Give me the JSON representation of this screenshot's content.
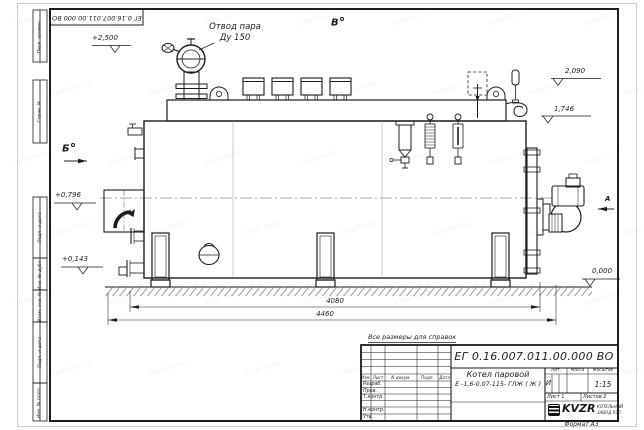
{
  "sheet": {
    "doc_number": "ЕГ 0.16.007.011.00.000  ВО",
    "format_label": "Формат А3",
    "reference_note": "Все размеры для справок",
    "watermark": "kotel-kv.kz"
  },
  "margin_graphs": {
    "perv_primen": "Перв. примен.",
    "sprav_no": "Справ. №",
    "podp_data_1": "Подп. и дата",
    "inv_dubl": "Инв. № дубл.",
    "vzam_inv": "Взам. инв. №",
    "podp_data_2": "Подп. и дата",
    "inv_podl": "Инв. № подл."
  },
  "annotations": {
    "steam_outlet_line1": "Отвод пара",
    "steam_outlet_line2": "Ду 150",
    "view_a": "А",
    "view_b": "Б",
    "view_v": "В",
    "levels": {
      "l2500": "+2,500",
      "l2090": "2,090",
      "l1746": "1,746",
      "l0796": "+0,796",
      "l0143": "+0,143",
      "l0000": "0,000"
    },
    "dims": {
      "d4080": "4080",
      "d4460": "4460"
    }
  },
  "title_block": {
    "product_name_line1": "Котел паровой",
    "product_name_line2": "Е -1,6-0,07-115- ГЛЖ ( Ж )",
    "headers": {
      "izm": "Изм.",
      "list": "Лист",
      "n_dokum": "N докум.",
      "podp": "Подп.",
      "data": "Дата",
      "lit": "Лит.",
      "massa": "Масса",
      "masshtab": "Масштаб"
    },
    "rows": {
      "razrab": "Разраб.",
      "prov": "Пров.",
      "t_kontr": "Т.контр.",
      "n_kontr": "Н.контр.",
      "utv": "Утв."
    },
    "lit_value": "И",
    "scale_value": "1:15",
    "sheet_info": {
      "list_label": "Лист",
      "list_value": "1",
      "listov_label": "Листов",
      "listov_value": "2"
    },
    "logo_text": "KVZR",
    "company_line1": "КОТЕЛЬНЫЙ",
    "company_line2": "ЗАВОД РЭП"
  }
}
